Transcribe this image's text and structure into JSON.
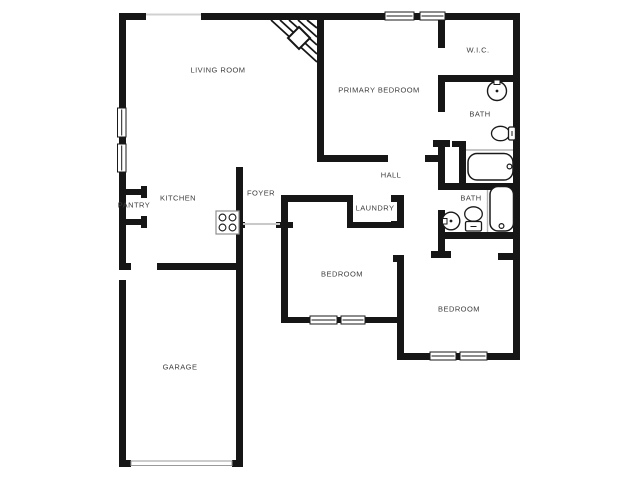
{
  "floorplan": {
    "type": "residential-floor-plan",
    "colors": {
      "background": "#ffffff",
      "walls": "#161616",
      "labels": "#3d3d3d",
      "thin_opening_line": "#c9c9c9",
      "fixture_outline": "#1a1a1a",
      "appliance_outline": "#8f8f8f"
    },
    "rooms": [
      {
        "name": "living-room",
        "label": "LIVING ROOM"
      },
      {
        "name": "primary-bedroom",
        "label": "PRIMARY BEDROOM"
      },
      {
        "name": "walk-in-closet",
        "label": "W.I.C."
      },
      {
        "name": "primary-bath",
        "label": "BATH"
      },
      {
        "name": "kitchen",
        "label": "KITCHEN"
      },
      {
        "name": "pantry",
        "label": "PANTRY"
      },
      {
        "name": "foyer",
        "label": "FOYER"
      },
      {
        "name": "hall",
        "label": "HALL"
      },
      {
        "name": "laundry",
        "label": "LAUNDRY"
      },
      {
        "name": "hall-bath",
        "label": "BATH"
      },
      {
        "name": "bedroom-center",
        "label": "BEDROOM"
      },
      {
        "name": "bedroom-right",
        "label": "BEDROOM"
      },
      {
        "name": "garage",
        "label": "GARAGE"
      }
    ],
    "fixtures": [
      "corner-fireplace-icon",
      "cooktop-icon",
      "sink-icon",
      "toilet-icon",
      "bathtub-icon",
      "window-symbol",
      "door-opening",
      "garage-door"
    ]
  }
}
